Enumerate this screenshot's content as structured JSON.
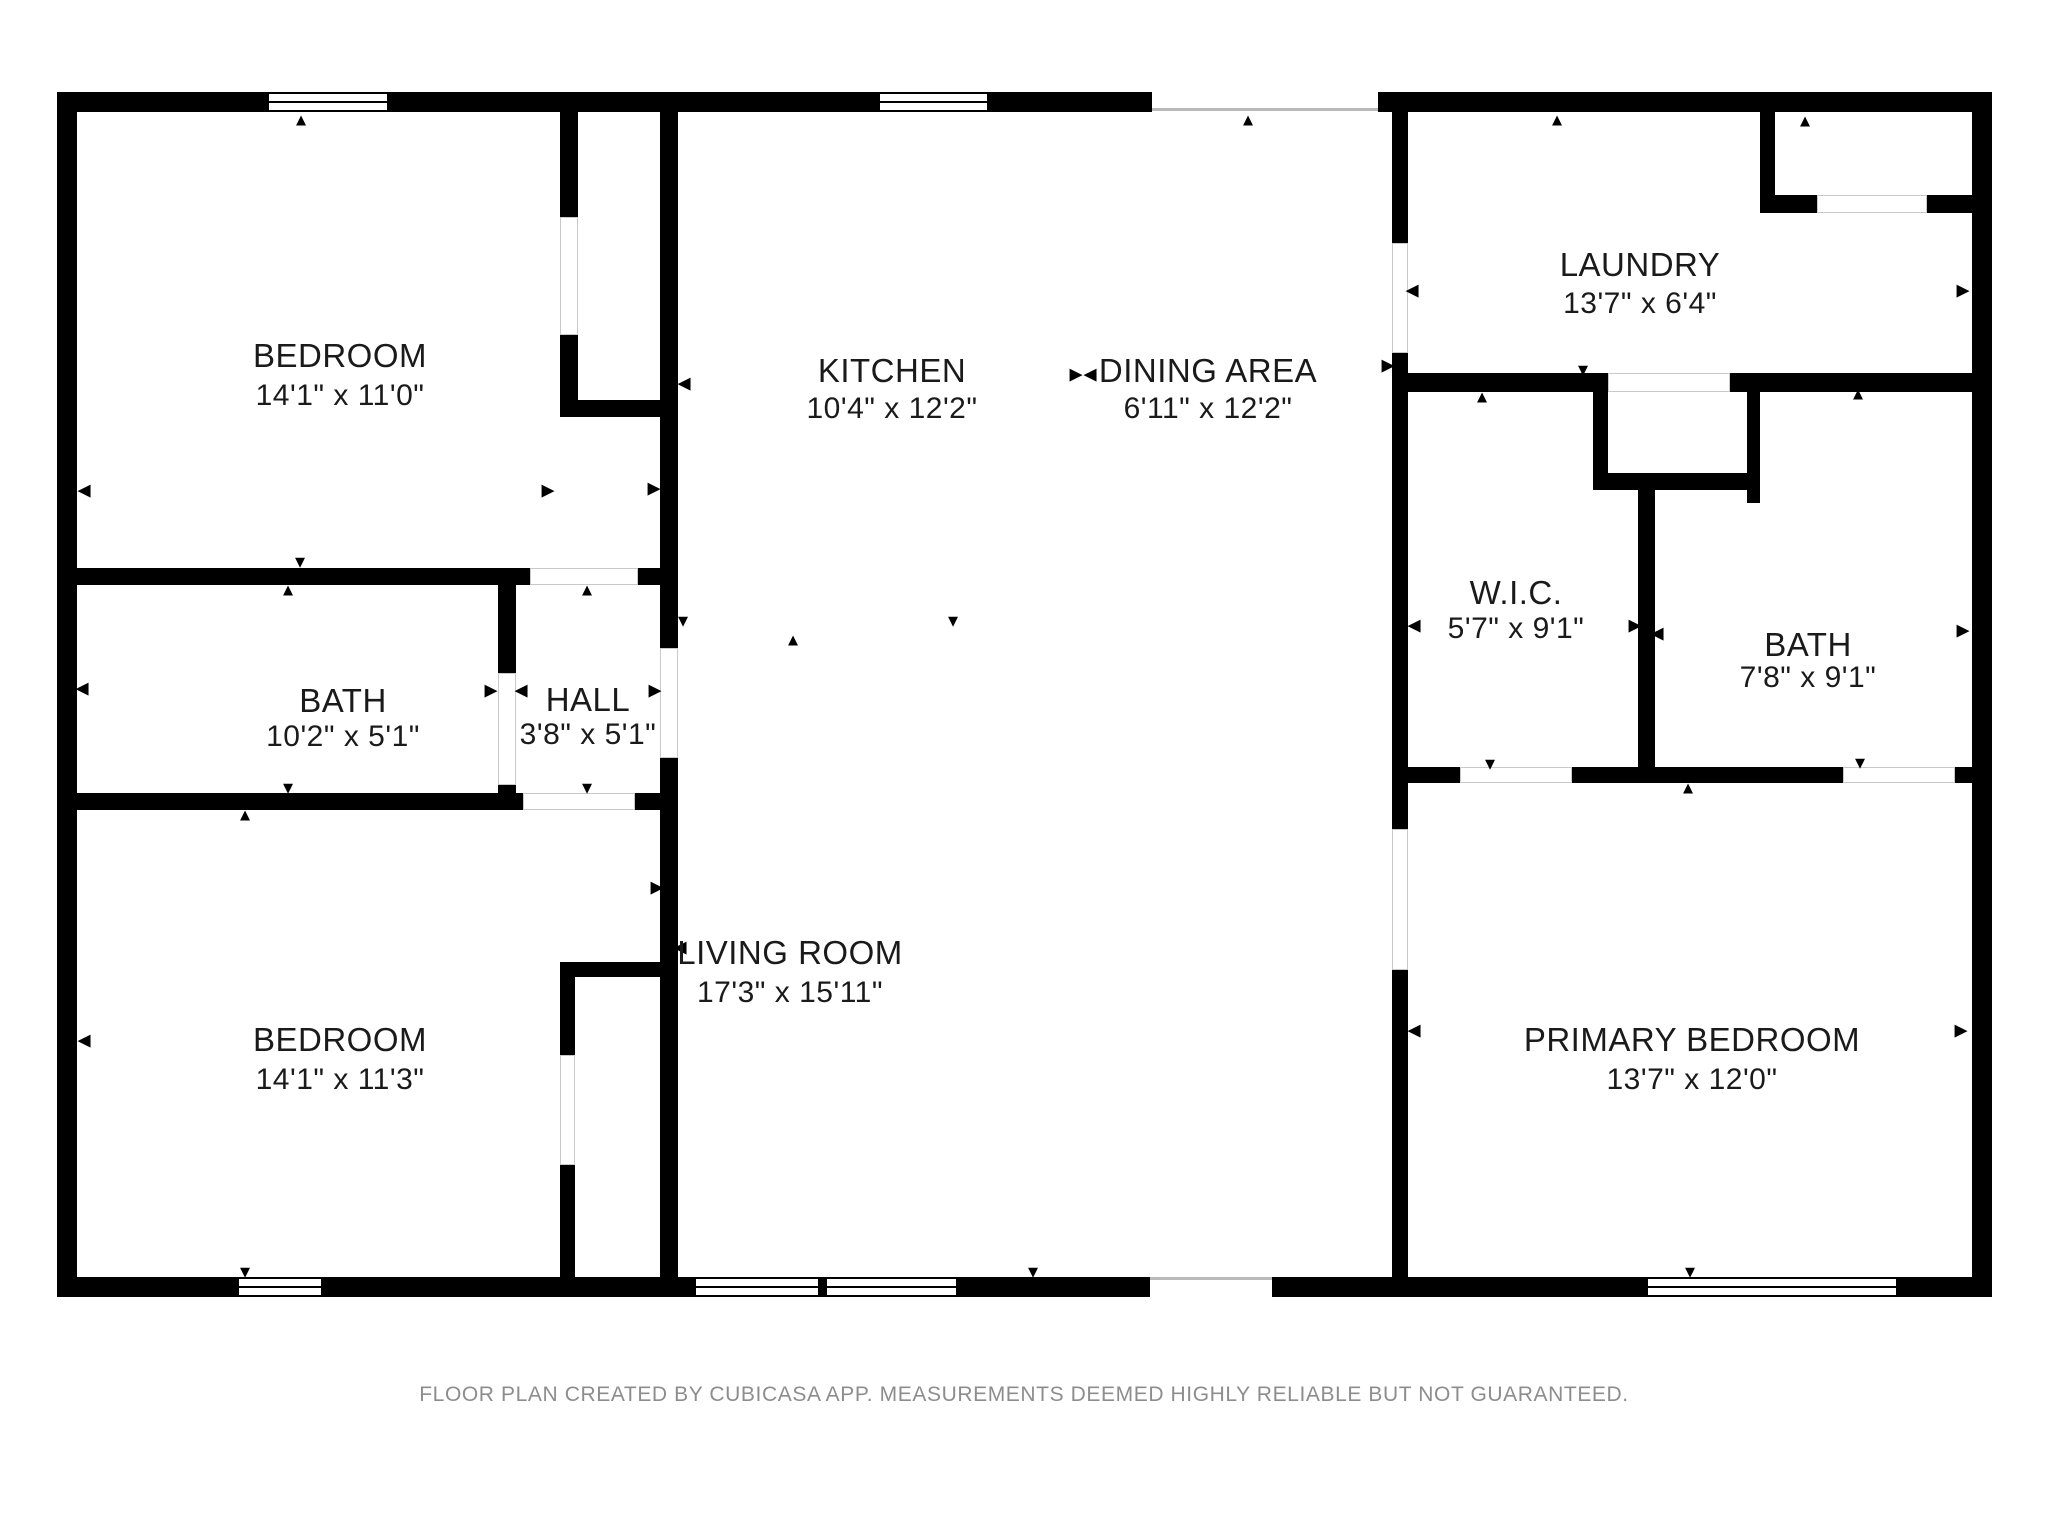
{
  "floorplan": {
    "colors": {
      "wall": "#000000",
      "text": "#1a1a1a",
      "footer_text": "#8d8d8d",
      "door_outline": "#c9c9c9",
      "opening_line": "#b9b9b9",
      "background": "#ffffff"
    },
    "footer": "FLOOR PLAN CREATED BY CUBICASA APP. MEASUREMENTS DEEMED HIGHLY RELIABLE BUT NOT GUARANTEED.",
    "rooms": [
      {
        "id": "bedroom-top-left",
        "name": "BEDROOM",
        "dims": "14'1\" x 11'0\"",
        "cx": 340,
        "ny": 356,
        "dy": 396
      },
      {
        "id": "kitchen",
        "name": "KITCHEN",
        "dims": "10'4\" x 12'2\"",
        "cx": 892,
        "ny": 371,
        "dy": 409
      },
      {
        "id": "dining-area",
        "name": "DINING AREA",
        "dims": "6'11\" x 12'2\"",
        "cx": 1208,
        "ny": 371,
        "dy": 409
      },
      {
        "id": "laundry",
        "name": "LAUNDRY",
        "dims": "13'7\" x 6'4\"",
        "cx": 1640,
        "ny": 265,
        "dy": 304
      },
      {
        "id": "bath-left",
        "name": "BATH",
        "dims": "10'2\" x 5'1\"",
        "cx": 343,
        "ny": 701,
        "dy": 737
      },
      {
        "id": "hall",
        "name": "HALL",
        "dims": "3'8\" x 5'1\"",
        "cx": 588,
        "ny": 700,
        "dy": 735
      },
      {
        "id": "walk-in-closet",
        "name": "W.I.C.",
        "dims": "5'7\" x 9'1\"",
        "cx": 1516,
        "ny": 593,
        "dy": 629
      },
      {
        "id": "bath-right",
        "name": "BATH",
        "dims": "7'8\" x 9'1\"",
        "cx": 1808,
        "ny": 645,
        "dy": 678
      },
      {
        "id": "bedroom-bottom-left",
        "name": "BEDROOM",
        "dims": "14'1\" x 11'3\"",
        "cx": 340,
        "ny": 1040,
        "dy": 1080
      },
      {
        "id": "living-room",
        "name": "LIVING ROOM",
        "dims": "17'3\" x 15'11\"",
        "cx": 790,
        "ny": 953,
        "dy": 993
      },
      {
        "id": "primary-bedroom",
        "name": "PRIMARY BEDROOM",
        "dims": "13'7\" x 12'0\"",
        "cx": 1692,
        "ny": 1040,
        "dy": 1080
      }
    ],
    "walls": [
      [
        57,
        92,
        1095,
        20
      ],
      [
        1378,
        92,
        614,
        20
      ],
      [
        57,
        92,
        20,
        1205
      ],
      [
        1972,
        92,
        20,
        1205
      ],
      [
        57,
        1277,
        1093,
        20
      ],
      [
        1272,
        1277,
        720,
        20
      ],
      [
        560,
        112,
        18,
        105
      ],
      [
        560,
        335,
        18,
        65
      ],
      [
        560,
        400,
        100,
        17
      ],
      [
        660,
        112,
        18,
        536
      ],
      [
        660,
        758,
        18,
        519
      ],
      [
        77,
        568,
        453,
        17
      ],
      [
        638,
        568,
        22,
        17
      ],
      [
        498,
        585,
        18,
        88
      ],
      [
        498,
        785,
        18,
        10
      ],
      [
        77,
        793,
        446,
        17
      ],
      [
        635,
        793,
        25,
        17
      ],
      [
        560,
        962,
        100,
        15
      ],
      [
        560,
        977,
        15,
        78
      ],
      [
        560,
        1165,
        15,
        112
      ],
      [
        1392,
        112,
        16,
        131
      ],
      [
        1392,
        353,
        16,
        476
      ],
      [
        1392,
        970,
        16,
        307
      ],
      [
        1760,
        112,
        15,
        101
      ],
      [
        1760,
        195,
        57,
        18
      ],
      [
        1927,
        195,
        45,
        18
      ],
      [
        1408,
        373,
        185,
        19
      ],
      [
        1730,
        373,
        242,
        19
      ],
      [
        1593,
        373,
        15,
        100
      ],
      [
        1593,
        473,
        154,
        17
      ],
      [
        1747,
        392,
        13,
        111
      ],
      [
        1638,
        490,
        17,
        277
      ],
      [
        1408,
        767,
        52,
        16
      ],
      [
        1572,
        767,
        271,
        16
      ],
      [
        1955,
        767,
        17,
        16
      ]
    ],
    "windows": [
      {
        "x": 258,
        "y": 92,
        "w": 140,
        "h": 20
      },
      {
        "x": 869,
        "y": 92,
        "w": 129,
        "h": 20
      },
      {
        "x": 228,
        "y": 1277,
        "w": 104,
        "h": 20
      },
      {
        "x": 685,
        "y": 1277,
        "w": 282,
        "h": 20,
        "mullion": 816
      },
      {
        "x": 1637,
        "y": 1277,
        "w": 270,
        "h": 20
      }
    ],
    "doors": [
      [
        560,
        217,
        18,
        118
      ],
      [
        530,
        568,
        108,
        17
      ],
      [
        498,
        673,
        18,
        112
      ],
      [
        660,
        648,
        18,
        110
      ],
      [
        523,
        793,
        112,
        17
      ],
      [
        560,
        1055,
        15,
        110
      ],
      [
        1392,
        243,
        16,
        110
      ],
      [
        1392,
        829,
        16,
        141
      ],
      [
        1608,
        373,
        122,
        19
      ],
      [
        1817,
        195,
        110,
        18
      ],
      [
        1460,
        767,
        112,
        16
      ],
      [
        1843,
        767,
        112,
        16
      ]
    ],
    "openings": [
      {
        "x": 1152,
        "y": 108,
        "w": 226
      },
      {
        "x": 1150,
        "y": 1277,
        "w": 122
      }
    ],
    "arrows": [
      {
        "x": 301,
        "y": 120,
        "d": "up"
      },
      {
        "x": 1248,
        "y": 120,
        "d": "up"
      },
      {
        "x": 1557,
        "y": 120,
        "d": "up"
      },
      {
        "x": 1805,
        "y": 121,
        "d": "up"
      },
      {
        "x": 84,
        "y": 490,
        "d": "left"
      },
      {
        "x": 548,
        "y": 490,
        "d": "right"
      },
      {
        "x": 684,
        "y": 383,
        "d": "left"
      },
      {
        "x": 654,
        "y": 488,
        "d": "right"
      },
      {
        "x": 300,
        "y": 562,
        "d": "down"
      },
      {
        "x": 288,
        "y": 590,
        "d": "up"
      },
      {
        "x": 82,
        "y": 688,
        "d": "left"
      },
      {
        "x": 491,
        "y": 690,
        "d": "right"
      },
      {
        "x": 521,
        "y": 690,
        "d": "left"
      },
      {
        "x": 655,
        "y": 690,
        "d": "right"
      },
      {
        "x": 587,
        "y": 590,
        "d": "up"
      },
      {
        "x": 587,
        "y": 788,
        "d": "down"
      },
      {
        "x": 288,
        "y": 788,
        "d": "down"
      },
      {
        "x": 245,
        "y": 815,
        "d": "up"
      },
      {
        "x": 84,
        "y": 1040,
        "d": "left"
      },
      {
        "x": 657,
        "y": 887,
        "d": "right"
      },
      {
        "x": 680,
        "y": 947,
        "d": "left"
      },
      {
        "x": 245,
        "y": 1272,
        "d": "down"
      },
      {
        "x": 1033,
        "y": 1272,
        "d": "down"
      },
      {
        "x": 683,
        "y": 621,
        "d": "down"
      },
      {
        "x": 793,
        "y": 640,
        "d": "up"
      },
      {
        "x": 953,
        "y": 621,
        "d": "down"
      },
      {
        "x": 1076,
        "y": 374,
        "d": "right"
      },
      {
        "x": 1090,
        "y": 374,
        "d": "left"
      },
      {
        "x": 1412,
        "y": 290,
        "d": "left"
      },
      {
        "x": 1388,
        "y": 365,
        "d": "right"
      },
      {
        "x": 1963,
        "y": 290,
        "d": "right"
      },
      {
        "x": 1583,
        "y": 370,
        "d": "down"
      },
      {
        "x": 1414,
        "y": 625,
        "d": "left"
      },
      {
        "x": 1635,
        "y": 625,
        "d": "right"
      },
      {
        "x": 1657,
        "y": 633,
        "d": "left"
      },
      {
        "x": 1482,
        "y": 397,
        "d": "up"
      },
      {
        "x": 1490,
        "y": 764,
        "d": "down"
      },
      {
        "x": 1858,
        "y": 394,
        "d": "up"
      },
      {
        "x": 1963,
        "y": 630,
        "d": "right"
      },
      {
        "x": 1860,
        "y": 763,
        "d": "down"
      },
      {
        "x": 1688,
        "y": 788,
        "d": "up"
      },
      {
        "x": 1414,
        "y": 1030,
        "d": "left"
      },
      {
        "x": 1961,
        "y": 1030,
        "d": "right"
      },
      {
        "x": 1690,
        "y": 1272,
        "d": "down"
      }
    ]
  }
}
